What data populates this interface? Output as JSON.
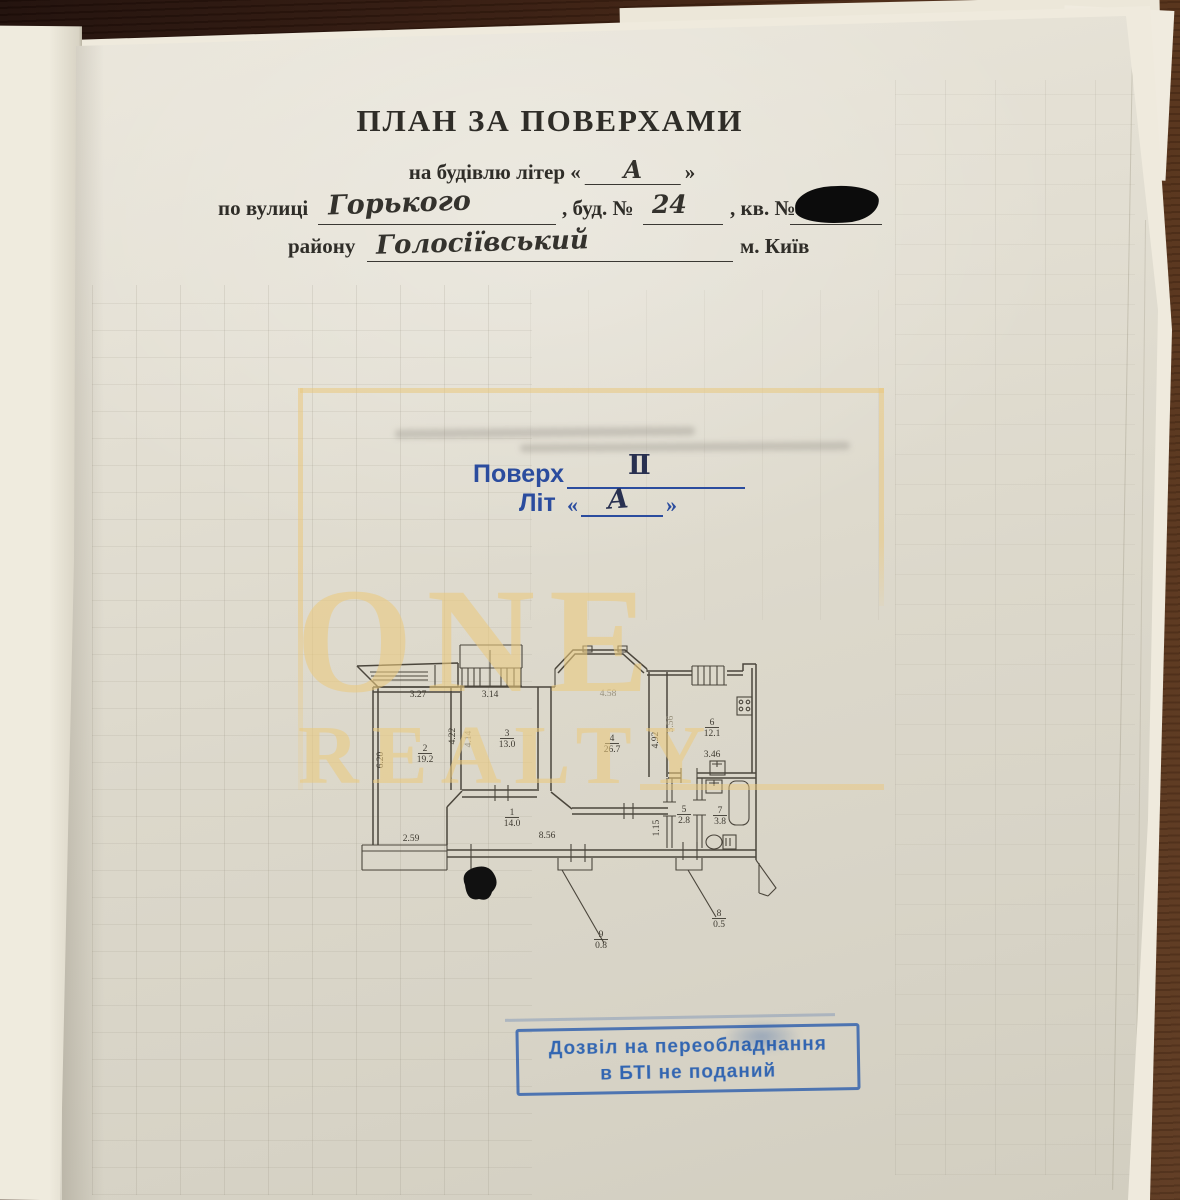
{
  "document": {
    "title": "ПЛАН ЗА ПОВЕРХАМИ",
    "building_line": {
      "prefix": "на будівлю літер «",
      "value": "А",
      "suffix": "»"
    },
    "street_line": {
      "label": "по вулиці",
      "street": "Горького",
      "bud_label": ", буд. №",
      "bud_value": "24",
      "kv_label": ", кв. №"
    },
    "district_line": {
      "label": "району",
      "district": "Голосіївський",
      "city": "м. Київ"
    }
  },
  "floor_stamp": {
    "floor_label": "Поверх",
    "floor_value": "Ⅱ",
    "lit_label": "Літ",
    "open_quote": "«",
    "lit_value": "А",
    "close_quote": "»"
  },
  "watermark": {
    "line1": "ONE",
    "line2": "REALTY"
  },
  "plan": {
    "labels": [
      {
        "t": "3.27",
        "x": 78,
        "y": 67
      },
      {
        "t": "3.14",
        "x": 150,
        "y": 67
      },
      {
        "t": "4.58",
        "x": 268,
        "y": 66,
        "f": 1
      },
      {
        "t": "6.20",
        "x": 43,
        "y": 130,
        "r": -90
      },
      {
        "t": "4.22",
        "x": 115,
        "y": 106,
        "r": -90
      },
      {
        "t": "4.14",
        "x": 131,
        "y": 109,
        "r": -90,
        "f": 1
      },
      {
        "t": "2",
        "x": 85,
        "y": 121,
        "u": 1
      },
      {
        "t": "19.2",
        "x": 85,
        "y": 132
      },
      {
        "t": "3",
        "x": 167,
        "y": 106,
        "u": 1
      },
      {
        "t": "13.0",
        "x": 167,
        "y": 117
      },
      {
        "t": "4",
        "x": 272,
        "y": 111,
        "u": 1
      },
      {
        "t": "26.7",
        "x": 272,
        "y": 122
      },
      {
        "t": "4.92",
        "x": 318,
        "y": 110,
        "r": -90
      },
      {
        "t": "3.56",
        "x": 333,
        "y": 94,
        "r": -90,
        "f": 1
      },
      {
        "t": "6",
        "x": 372,
        "y": 95,
        "u": 1
      },
      {
        "t": "12.1",
        "x": 372,
        "y": 106
      },
      {
        "t": "3.46",
        "x": 372,
        "y": 127
      },
      {
        "t": "1",
        "x": 172,
        "y": 185,
        "u": 1
      },
      {
        "t": "14.0",
        "x": 172,
        "y": 196
      },
      {
        "t": "8.56",
        "x": 207,
        "y": 208
      },
      {
        "t": "2.59",
        "x": 71,
        "y": 211
      },
      {
        "t": "1.15",
        "x": 319,
        "y": 198,
        "r": -90
      },
      {
        "t": "5",
        "x": 344,
        "y": 182,
        "u": 1
      },
      {
        "t": "2.8",
        "x": 344,
        "y": 193
      },
      {
        "t": "7",
        "x": 380,
        "y": 183,
        "u": 1
      },
      {
        "t": "3.8",
        "x": 380,
        "y": 194
      },
      {
        "t": "9",
        "x": 261,
        "y": 307,
        "u": 1
      },
      {
        "t": "0.8",
        "x": 261,
        "y": 318
      },
      {
        "t": "8",
        "x": 379,
        "y": 286,
        "u": 1
      },
      {
        "t": "0.5",
        "x": 379,
        "y": 297
      }
    ]
  },
  "bti_stamp": {
    "line1": "Дозвіл на переобладнання",
    "line2": "в БТІ не поданий"
  },
  "colors": {
    "floor_stamp_blue": "#2b4c9e",
    "bti_stamp_blue": "#245cb0",
    "ink": "#2f2d28",
    "handwriting_ink": "#34322d",
    "watermark_gold": "#eac87e",
    "plan_ink": "#4b463c",
    "desk_brown": "#452614"
  }
}
